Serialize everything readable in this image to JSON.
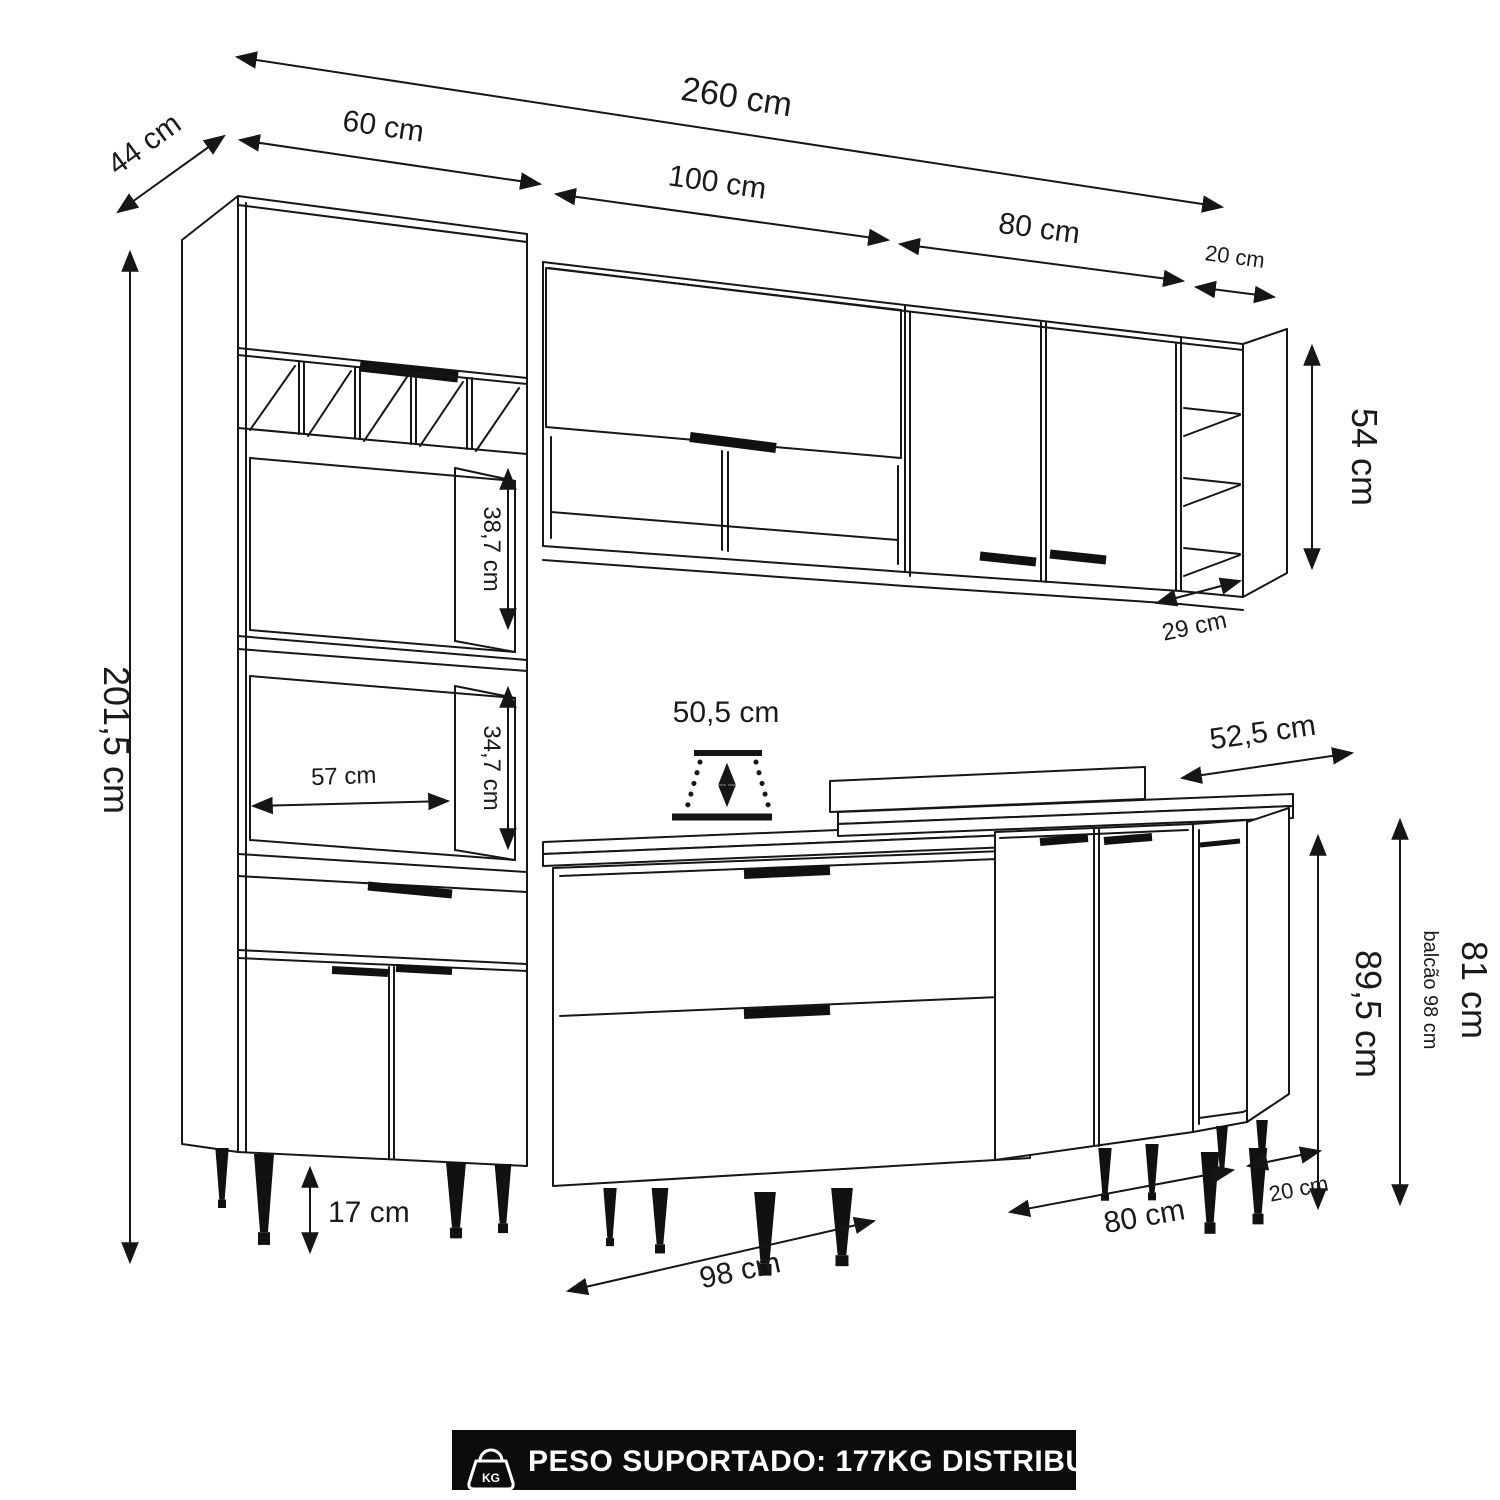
{
  "page": {
    "background": "#ffffff",
    "line_color": "#161616",
    "banner_background": "#0c0c0c",
    "banner_text_color": "#ffffff"
  },
  "dimensions": {
    "total_width": "260 cm",
    "depth": "44 cm",
    "tall_cabinet_width": "60 cm",
    "wall_cabinet_center_width": "100 cm",
    "wall_cabinet_right_width": "80 cm",
    "wall_shelf_end_width": "20 cm",
    "wall_cabinet_height": "54 cm",
    "wall_cabinet_depth": "29 cm",
    "total_height": "201,5 cm",
    "tall_niche_upper_height": "38,7 cm",
    "tall_niche_lower_height": "34,7 cm",
    "tall_niche_width": "57 cm",
    "counter_clearance": "50,5 cm",
    "countertop_depth": "52,5 cm",
    "counter_height_with_top": "89,5 cm",
    "counter_cabinet_height": "81 cm",
    "counter_total_note": "balcão 98 cm",
    "leg_height": "17 cm",
    "base_cabinet_left_width": "98 cm",
    "base_cabinet_right_width": "80 cm",
    "base_shelf_end_width": "20 cm"
  },
  "banner": {
    "label": "PESO SUPORTADO: 177KG DISTRIBUÍDOS",
    "icon": "kg-weight-icon"
  }
}
